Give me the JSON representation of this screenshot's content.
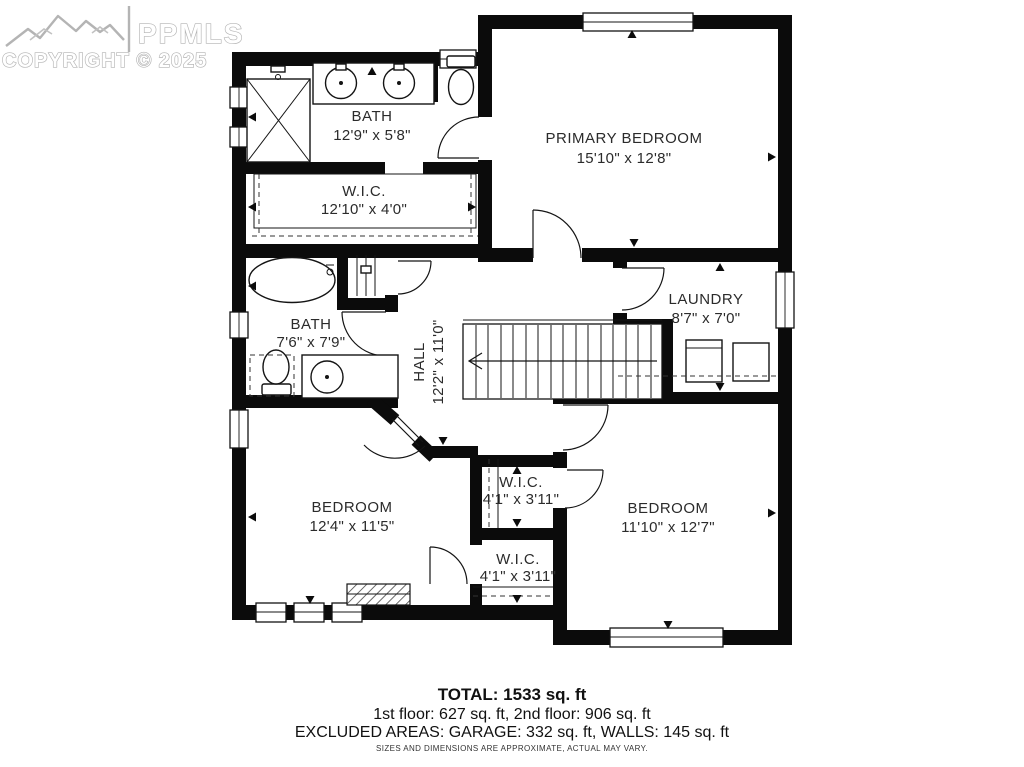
{
  "logo": {
    "brand": "PPMLS",
    "copyright": "COPYRIGHT © 2025"
  },
  "rooms": {
    "bath_top": {
      "name": "BATH",
      "dims": "12'9\" x 5'8\""
    },
    "primary_bedroom": {
      "name": "PRIMARY BEDROOM",
      "dims": "15'10\" x 12'8\""
    },
    "wic_main": {
      "name": "W.I.C.",
      "dims": "12'10\" x 4'0\""
    },
    "bath_hall": {
      "name": "BATH",
      "dims": "7'6\" x 7'9\""
    },
    "hall": {
      "name": "HALL",
      "dims": "12'2\" x 11'0\""
    },
    "laundry": {
      "name": "LAUNDRY",
      "dims": "8'7\" x 7'0\""
    },
    "bedroom_left": {
      "name": "BEDROOM",
      "dims": "12'4\" x 11'5\""
    },
    "wic_upper": {
      "name": "W.I.C.",
      "dims": "4'1\" x 3'11\""
    },
    "wic_lower": {
      "name": "W.I.C.",
      "dims": "4'1\" x 3'11\""
    },
    "bedroom_right": {
      "name": "BEDROOM",
      "dims": "11'10\" x 12'7\""
    }
  },
  "summary": {
    "total": "TOTAL: 1533 sq. ft",
    "floors": "1st floor: 627 sq. ft, 2nd floor: 906 sq. ft",
    "excluded": "EXCLUDED AREAS: GARAGE: 332 sq. ft, WALLS: 145 sq. ft",
    "disclaimer": "SIZES AND DIMENSIONS ARE APPROXIMATE, ACTUAL MAY VARY."
  }
}
